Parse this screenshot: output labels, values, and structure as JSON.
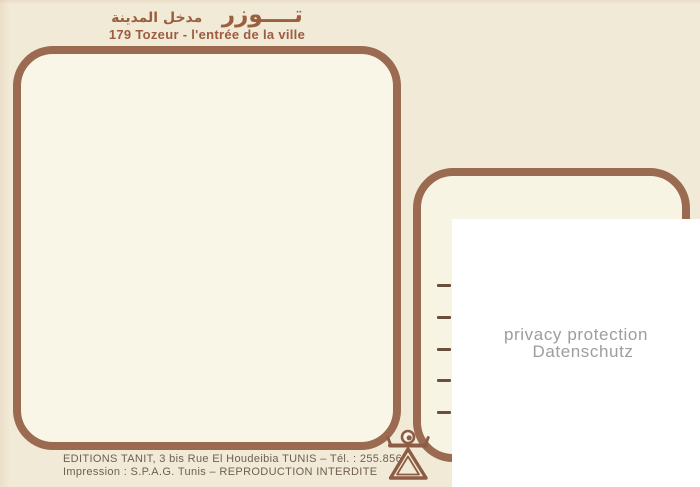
{
  "header": {
    "arabic_main": "تــــوزر",
    "arabic_sub": "مدخل المدينة",
    "title": "179 Tozeur - l'entrée de la ville"
  },
  "right_frame": {
    "address_line_count": 5
  },
  "privacy_overlay": {
    "line1": "privacy protection",
    "line2": "Datenschutz"
  },
  "footer": {
    "publisher_line": "EDITIONS TANIT, 3 bis Rue El Houdeibia TUNIS – Tél. : 255.856",
    "printer_line": "Impression : S.P.A.G. Tunis – REPRODUCTION INTERDITE"
  },
  "logo": {
    "name": "tanit-symbol"
  },
  "colors": {
    "card_background": "#f1ead7",
    "frame_brown": "#9a6a51",
    "title_brown": "#9c5c41",
    "footer_text": "#6f5e53",
    "privacy_gray": "#9d9d9d",
    "frame_interior": "#faf6e7",
    "overlay_white": "#ffffff"
  }
}
